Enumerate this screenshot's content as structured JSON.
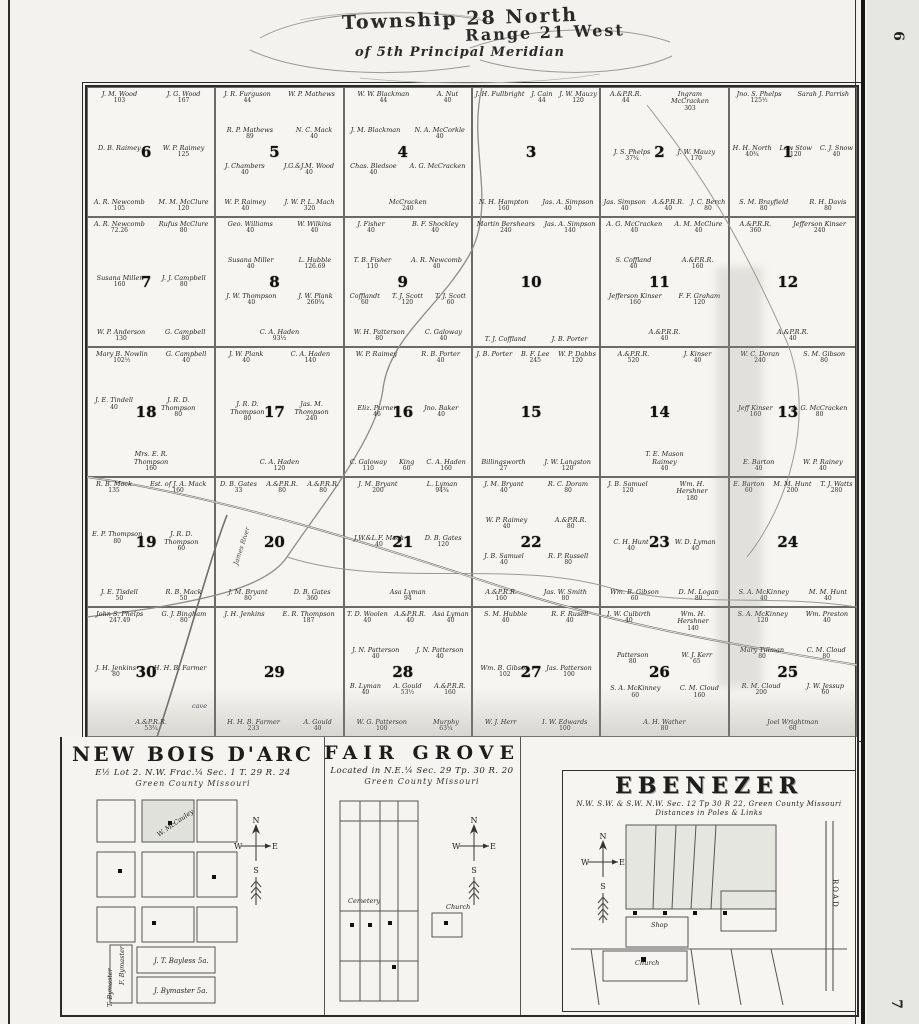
{
  "page": {
    "number_top": "6",
    "number_bottom": "7"
  },
  "title": {
    "line1": "Township 28 North",
    "line2": "Range 21 West",
    "line3": "of 5th Principal Meridian"
  },
  "compass": {
    "north": "N",
    "west": "W",
    "east": "E",
    "south": "S"
  },
  "map_labels": {
    "james_river": "James River",
    "cave": "cave"
  },
  "township": {
    "sections": [
      {
        "number": "6",
        "parcels": [
          {
            "n": "J. M. Wood",
            "a": "103"
          },
          {
            "n": "J. G. Wood",
            "a": "167"
          },
          {
            "n": "D. B. Raimey"
          },
          {
            "n": "W. P. Raimey",
            "a": "125"
          },
          {
            "n": "A. R. Newcomb",
            "a": "105"
          },
          {
            "n": "M. M. McClure",
            "a": "120"
          }
        ]
      },
      {
        "number": "5",
        "parcels": [
          {
            "n": "J. R. Furguson",
            "a": "44"
          },
          {
            "n": "W. P. Mathews"
          },
          {
            "n": "R. P. Mathews",
            "a": "89"
          },
          {
            "n": "N. C. Mack",
            "a": "40"
          },
          {
            "n": "J. Chambers",
            "a": "40"
          },
          {
            "n": "J.G.&J.M. Wood",
            "a": "40"
          },
          {
            "n": "W. P. Raimey",
            "a": "40"
          },
          {
            "n": "J. W. P. L. Mach",
            "a": "320"
          }
        ]
      },
      {
        "number": "4",
        "parcels": [
          {
            "n": "W. W. Blackman",
            "a": "44"
          },
          {
            "n": "A. Nut",
            "a": "40"
          },
          {
            "n": "J. M. Blackman"
          },
          {
            "n": "N. A. McCorkle",
            "a": "40"
          },
          {
            "n": "Chas. Bledsoe",
            "a": "40"
          },
          {
            "n": "A. G. McCracken"
          },
          {
            "n": "McCracken",
            "a": "240"
          }
        ]
      },
      {
        "number": "3",
        "parcels": [
          {
            "n": "J. H. Fullbright"
          },
          {
            "n": "J. Cain",
            "a": "44"
          },
          {
            "n": "J. W. Mauzy",
            "a": "120"
          },
          {
            "n": "N. H. Hampton",
            "a": "160"
          },
          {
            "n": "Jas. A. Simpson",
            "a": "40"
          }
        ]
      },
      {
        "number": "2",
        "parcels": [
          {
            "n": "A.&P.R.R.",
            "a": "44"
          },
          {
            "n": "Ingram McCracken",
            "a": "303"
          },
          {
            "n": "J. S. Phelps",
            "a": "37¾"
          },
          {
            "n": "J. W. Mauzy",
            "a": "170"
          },
          {
            "n": "Jas. Simpson",
            "a": "40"
          },
          {
            "n": "A.&P.R.R.",
            "a": "40"
          },
          {
            "n": "J. C. Berch",
            "a": "80"
          }
        ]
      },
      {
        "number": "1",
        "parcels": [
          {
            "n": "Jno. S. Phelps",
            "a": "125½"
          },
          {
            "n": "Sarah J. Parrish"
          },
          {
            "n": "H. H. North",
            "a": "40¾"
          },
          {
            "n": "Low Stow",
            "a": "120"
          },
          {
            "n": "C. J. Snow",
            "a": "40"
          },
          {
            "n": "S. M. Brayfield",
            "a": "80"
          },
          {
            "n": "R. H. Davis",
            "a": "80"
          }
        ]
      },
      {
        "number": "7",
        "parcels": [
          {
            "n": "A. R. Newcomb",
            "a": "72.26"
          },
          {
            "n": "Rufus McClure",
            "a": "80"
          },
          {
            "n": "Susana Miller",
            "a": "160"
          },
          {
            "n": "J. J. Campbell",
            "a": "80"
          },
          {
            "n": "W. P. Anderson",
            "a": "130"
          },
          {
            "n": "G. Campbell",
            "a": "80"
          }
        ]
      },
      {
        "number": "8",
        "parcels": [
          {
            "n": "Geo. Williams",
            "a": "40"
          },
          {
            "n": "W. Wilkins",
            "a": "40"
          },
          {
            "n": "Susana Miller",
            "a": "40"
          },
          {
            "n": "L. Hubble",
            "a": "126.69"
          },
          {
            "n": "J. W. Thompson",
            "a": "40"
          },
          {
            "n": "J. W. Plank",
            "a": "260¾"
          },
          {
            "n": "C. A. Haden",
            "a": "93⅓"
          }
        ]
      },
      {
        "number": "9",
        "parcels": [
          {
            "n": "J. Fisher",
            "a": "40"
          },
          {
            "n": "B. F. Shockley",
            "a": "40"
          },
          {
            "n": "T. B. Fisher",
            "a": "110"
          },
          {
            "n": "A. R. Newcomb",
            "a": "40"
          },
          {
            "n": "Cofflandt",
            "a": "60"
          },
          {
            "n": "T. J. Scott",
            "a": "120"
          },
          {
            "n": "T. J. Scott",
            "a": "60"
          },
          {
            "n": "W. H. Patterson",
            "a": "80"
          },
          {
            "n": "C. Galoway",
            "a": "40"
          }
        ]
      },
      {
        "number": "10",
        "parcels": [
          {
            "n": "Martin Bershears",
            "a": "240"
          },
          {
            "n": "Jas. A. Simpson",
            "a": "140"
          },
          {
            "n": "T. J. Coffland"
          },
          {
            "n": "J. B. Porter"
          }
        ]
      },
      {
        "number": "11",
        "parcels": [
          {
            "n": "A. G. McCracken",
            "a": "40"
          },
          {
            "n": "A. M. McClure",
            "a": "40"
          },
          {
            "n": "S. Coffland",
            "a": "40"
          },
          {
            "n": "A.&P.R.R.",
            "a": "160"
          },
          {
            "n": "Jefferson Kinser",
            "a": "160"
          },
          {
            "n": "F. F. Graham",
            "a": "120"
          },
          {
            "n": "A.&P.R.R.",
            "a": "40"
          }
        ]
      },
      {
        "number": "12",
        "parcels": [
          {
            "n": "A.&P.R.R.",
            "a": "360"
          },
          {
            "n": "Jefferson Kinser",
            "a": "240"
          },
          {
            "n": "A.&P.R.R.",
            "a": "40"
          }
        ]
      },
      {
        "number": "18",
        "parcels": [
          {
            "n": "Mary B. Nowlin",
            "a": "102½"
          },
          {
            "n": "G. Campbell",
            "a": "40"
          },
          {
            "n": "J. E. Tindell",
            "a": "40"
          },
          {
            "n": "J. R. D. Thompson",
            "a": "80"
          },
          {
            "n": "Mrs. E. R. Thompson",
            "a": "160"
          }
        ]
      },
      {
        "number": "17",
        "parcels": [
          {
            "n": "J. W. Plank",
            "a": "40"
          },
          {
            "n": "C. A. Haden",
            "a": "140"
          },
          {
            "n": "J. R. D. Thompson",
            "a": "80"
          },
          {
            "n": "Jas. M. Thompson",
            "a": "240"
          },
          {
            "n": "C. A. Haden",
            "a": "120"
          }
        ]
      },
      {
        "number": "16",
        "parcels": [
          {
            "n": "W. P. Raimey"
          },
          {
            "n": "R. B. Porter",
            "a": "40"
          },
          {
            "n": "Eliz. Purner",
            "a": "46"
          },
          {
            "n": "Jno. Baker",
            "a": "40"
          },
          {
            "n": "C. Galoway",
            "a": "110"
          },
          {
            "n": "King",
            "a": "60"
          },
          {
            "n": "C. A. Haden",
            "a": "160"
          }
        ]
      },
      {
        "number": "15",
        "parcels": [
          {
            "n": "J. B. Porter"
          },
          {
            "n": "B. F. Lee",
            "a": "245"
          },
          {
            "n": "W. P. Dabbs",
            "a": "120"
          },
          {
            "n": "Billingsworth",
            "a": "27"
          },
          {
            "n": "J. W. Langston",
            "a": "120"
          }
        ]
      },
      {
        "number": "14",
        "parcels": [
          {
            "n": "A.&P.R.R.",
            "a": "520"
          },
          {
            "n": "J. Kinser",
            "a": "40"
          },
          {
            "n": "T. E. Mason Raimey",
            "a": "40"
          }
        ]
      },
      {
        "number": "13",
        "parcels": [
          {
            "n": "W. C. Doran",
            "a": "240"
          },
          {
            "n": "S. M. Gibson",
            "a": "80"
          },
          {
            "n": "Jeff Kinser",
            "a": "160"
          },
          {
            "n": "A. G. McCracken",
            "a": "80"
          },
          {
            "n": "E. Barton",
            "a": "40"
          },
          {
            "n": "W. P. Rainey",
            "a": "40"
          }
        ]
      },
      {
        "number": "19",
        "parcels": [
          {
            "n": "R. B. Mack",
            "a": "135"
          },
          {
            "n": "Est. of J. A. Mack",
            "a": "160"
          },
          {
            "n": "E. P. Thompson",
            "a": "80"
          },
          {
            "n": "J. R. D. Thompson",
            "a": "60"
          },
          {
            "n": "J. E. Tisdell",
            "a": "50"
          },
          {
            "n": "R. B. Mack",
            "a": "50"
          }
        ]
      },
      {
        "number": "20",
        "parcels": [
          {
            "n": "D. B. Gates",
            "a": "33"
          },
          {
            "n": "A.&P.R.R.",
            "a": "80"
          },
          {
            "n": "A.&P.R.R.",
            "a": "80"
          },
          {
            "n": "J. M. Bryant",
            "a": "80"
          },
          {
            "n": "D. B. Gates",
            "a": "360"
          }
        ]
      },
      {
        "number": "21",
        "parcels": [
          {
            "n": "J. M. Bryant",
            "a": "200"
          },
          {
            "n": "L. Lyman",
            "a": "94¾"
          },
          {
            "n": "J.W.&L.F. Mach",
            "a": "40"
          },
          {
            "n": "D. B. Gates",
            "a": "120"
          },
          {
            "n": "Asa Lyman",
            "a": "94"
          }
        ]
      },
      {
        "number": "22",
        "parcels": [
          {
            "n": "J. M. Bryant",
            "a": "40"
          },
          {
            "n": "R. C. Doram",
            "a": "80"
          },
          {
            "n": "W. P. Raimey",
            "a": "40"
          },
          {
            "n": "A.&P.R.R.",
            "a": "80"
          },
          {
            "n": "J. B. Samuel",
            "a": "40"
          },
          {
            "n": "R. P. Russell",
            "a": "80"
          },
          {
            "n": "A.&P.R.R.",
            "a": "160"
          },
          {
            "n": "Jas. W. Smith",
            "a": "80"
          }
        ]
      },
      {
        "number": "23",
        "parcels": [
          {
            "n": "J. B. Samuel",
            "a": "120"
          },
          {
            "n": "Wm. H. Hershner",
            "a": "180"
          },
          {
            "n": "C. H. Hunt",
            "a": "40"
          },
          {
            "n": "W. D. Lyman",
            "a": "40"
          },
          {
            "n": "Wm. B. Gibson",
            "a": "60"
          },
          {
            "n": "D. M. Logan",
            "a": "80"
          }
        ]
      },
      {
        "number": "24",
        "parcels": [
          {
            "n": "E. Barton",
            "a": "60"
          },
          {
            "n": "M. M. Hunt",
            "a": "200"
          },
          {
            "n": "T. J. Watts",
            "a": "280"
          },
          {
            "n": "S. A. McKinney",
            "a": "40"
          },
          {
            "n": "M. M. Hunt",
            "a": "40"
          }
        ]
      },
      {
        "number": "30",
        "parcels": [
          {
            "n": "John S. Phelps",
            "a": "247.49"
          },
          {
            "n": "G. J. Bingham",
            "a": "80"
          },
          {
            "n": "J. H. Jenkins",
            "a": "80"
          },
          {
            "n": "H. H. B. Farmer"
          },
          {
            "n": "A.&P.R.R.",
            "a": "53¾"
          }
        ]
      },
      {
        "number": "29",
        "parcels": [
          {
            "n": "J. H. Jenkins"
          },
          {
            "n": "E. R. Thompson",
            "a": "187"
          },
          {
            "n": "H. H. B. Farmer",
            "a": "233"
          },
          {
            "n": "A. Gould",
            "a": "40"
          }
        ]
      },
      {
        "number": "28",
        "parcels": [
          {
            "n": "T. D. Woolen",
            "a": "40"
          },
          {
            "n": "A.&P.R.R.",
            "a": "40"
          },
          {
            "n": "Asa Lyman",
            "a": "40"
          },
          {
            "n": "J. N. Patterson",
            "a": "40"
          },
          {
            "n": "J. N. Patterson",
            "a": "40"
          },
          {
            "n": "B. Lyman",
            "a": "40"
          },
          {
            "n": "A. Gould",
            "a": "53½"
          },
          {
            "n": "A.&P.R.R.",
            "a": "160"
          },
          {
            "n": "W. G. Patterson",
            "a": "100"
          },
          {
            "n": "Murphy",
            "a": "63¼"
          }
        ]
      },
      {
        "number": "27",
        "parcels": [
          {
            "n": "S. M. Hubble",
            "a": "40"
          },
          {
            "n": "R. F. Rusell",
            "a": "40"
          },
          {
            "n": "Wm. B. Gibson",
            "a": "102"
          },
          {
            "n": "Jas. Patterson",
            "a": "100"
          },
          {
            "n": "W. J. Herr"
          },
          {
            "n": "I. W. Edwards",
            "a": "100"
          }
        ]
      },
      {
        "number": "26",
        "parcels": [
          {
            "n": "I. W. Culbirth",
            "a": "40"
          },
          {
            "n": "Wm. H. Hershner",
            "a": "140"
          },
          {
            "n": "Patterson",
            "a": "80"
          },
          {
            "n": "W. J. Kerr",
            "a": "65"
          },
          {
            "n": "S. A. McKinney",
            "a": "60"
          },
          {
            "n": "C. M. Cloud",
            "a": "160"
          },
          {
            "n": "A. H. Wather",
            "a": "80"
          }
        ]
      },
      {
        "number": "25",
        "parcels": [
          {
            "n": "S. A. McKinney",
            "a": "120"
          },
          {
            "n": "Wm. Preston",
            "a": "40"
          },
          {
            "n": "Mary Tillman",
            "a": "80"
          },
          {
            "n": "C. M. Cloud",
            "a": "80"
          },
          {
            "n": "R. M. Cloud",
            "a": "200"
          },
          {
            "n": "J. W. Jessup",
            "a": "60"
          },
          {
            "n": "Joel Wrightman",
            "a": "60"
          }
        ]
      }
    ]
  },
  "insets": {
    "new_bois_darc": {
      "title": "NEW BOIS D'ARC",
      "location": "E½ Lot 2. N.W. Frac.¼ Sec. 1 T. 29 R. 24",
      "county": "Green County Missouri",
      "block_label": "W. McCauley",
      "parcel1": "J. T. Bayless 5a.",
      "parcel2": "J. Bymaster 5a.",
      "parcel3": "F. Bymaster",
      "parcel4": "T. Bymaster"
    },
    "fair_grove": {
      "title": "FAIR GROVE",
      "location": "Located in N.E.¼ Sec. 29 Tp. 30 R. 20",
      "county": "Green County Missouri",
      "label1": "Cemetery",
      "label2": "Church"
    },
    "ebenezer": {
      "title": "EBENEZER",
      "location": "N.W. S.W. & S.W. N.W. Sec. 12 Tp 30 R 22, Green County Missouri",
      "note": "Distances in Poles & Links",
      "label1": "Shop",
      "label2": "Church",
      "label3": "ROAD"
    }
  }
}
